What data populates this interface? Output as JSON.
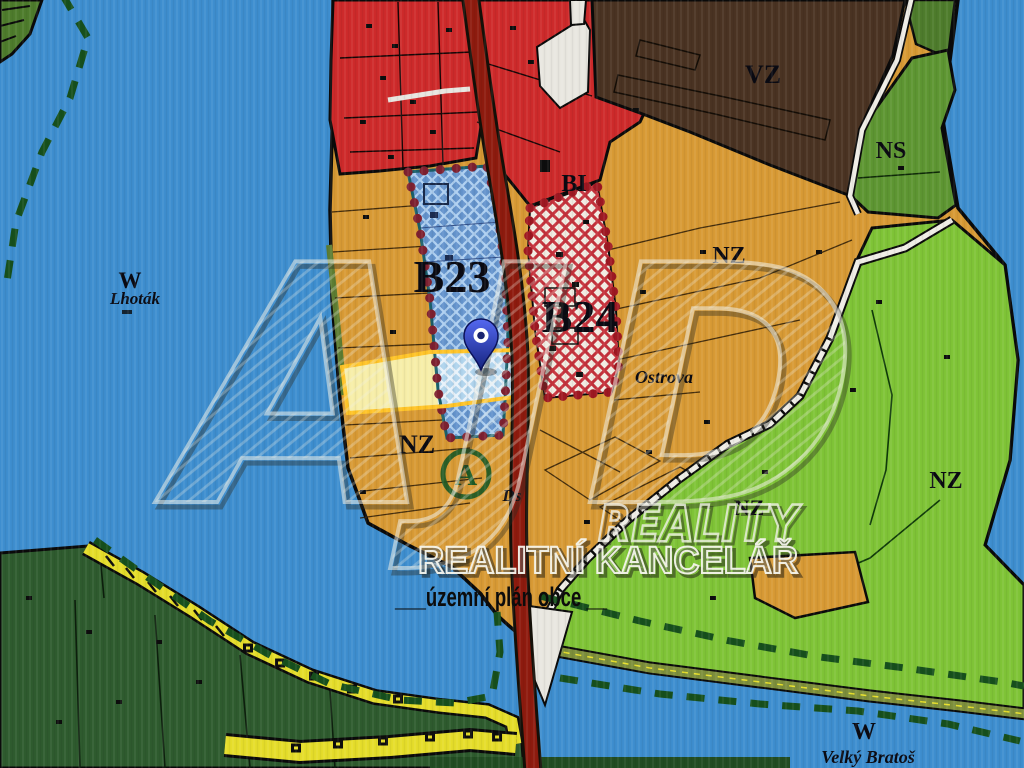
{
  "map": {
    "type": "municipal zoning plan (územní plán) with highlighted parcel and location pin",
    "labels": {
      "w": "W",
      "lhotak": "Lhoták",
      "b23": "B23",
      "b24": "B24",
      "bi": "BI",
      "vz": "VZ",
      "ns": "NS",
      "nz": "NZ",
      "ostrova": "Ostrova",
      "ds": "Ds",
      "a_symbol": "A",
      "velky_bratos": "Velký Bratoš"
    },
    "colors": {
      "water": "#3E8ECF",
      "farmland_orange": "#D89A35",
      "residential_red": "#CE2A2B",
      "road_dark_red": "#8E1B0E",
      "industrial_brown": "#4A3322",
      "green_ns": "#5E9632",
      "green_light": "#7FC437",
      "forest_dark": "#2E5B2E",
      "yellow_path": "#E5DD2A",
      "parcel_fill": "#F7EEA8",
      "parcel_border": "#FFC428",
      "b23_base": "#6493CC",
      "b23_hatch": "#AECFF0",
      "b24_base": "#F1ECE2",
      "b24_hatch": "#C5323C",
      "boundary_dash_green": "#17501D",
      "pin_blue": "#2B3BD6",
      "white_area": "#E9E7E0",
      "dot_border_maroon": "#7E2130"
    }
  },
  "watermark": {
    "logo": "AJD",
    "reality": "REALITY",
    "kancelar": "REALITNÍ KANCELÁŘ",
    "plan_line": "___územní plán obce __"
  }
}
